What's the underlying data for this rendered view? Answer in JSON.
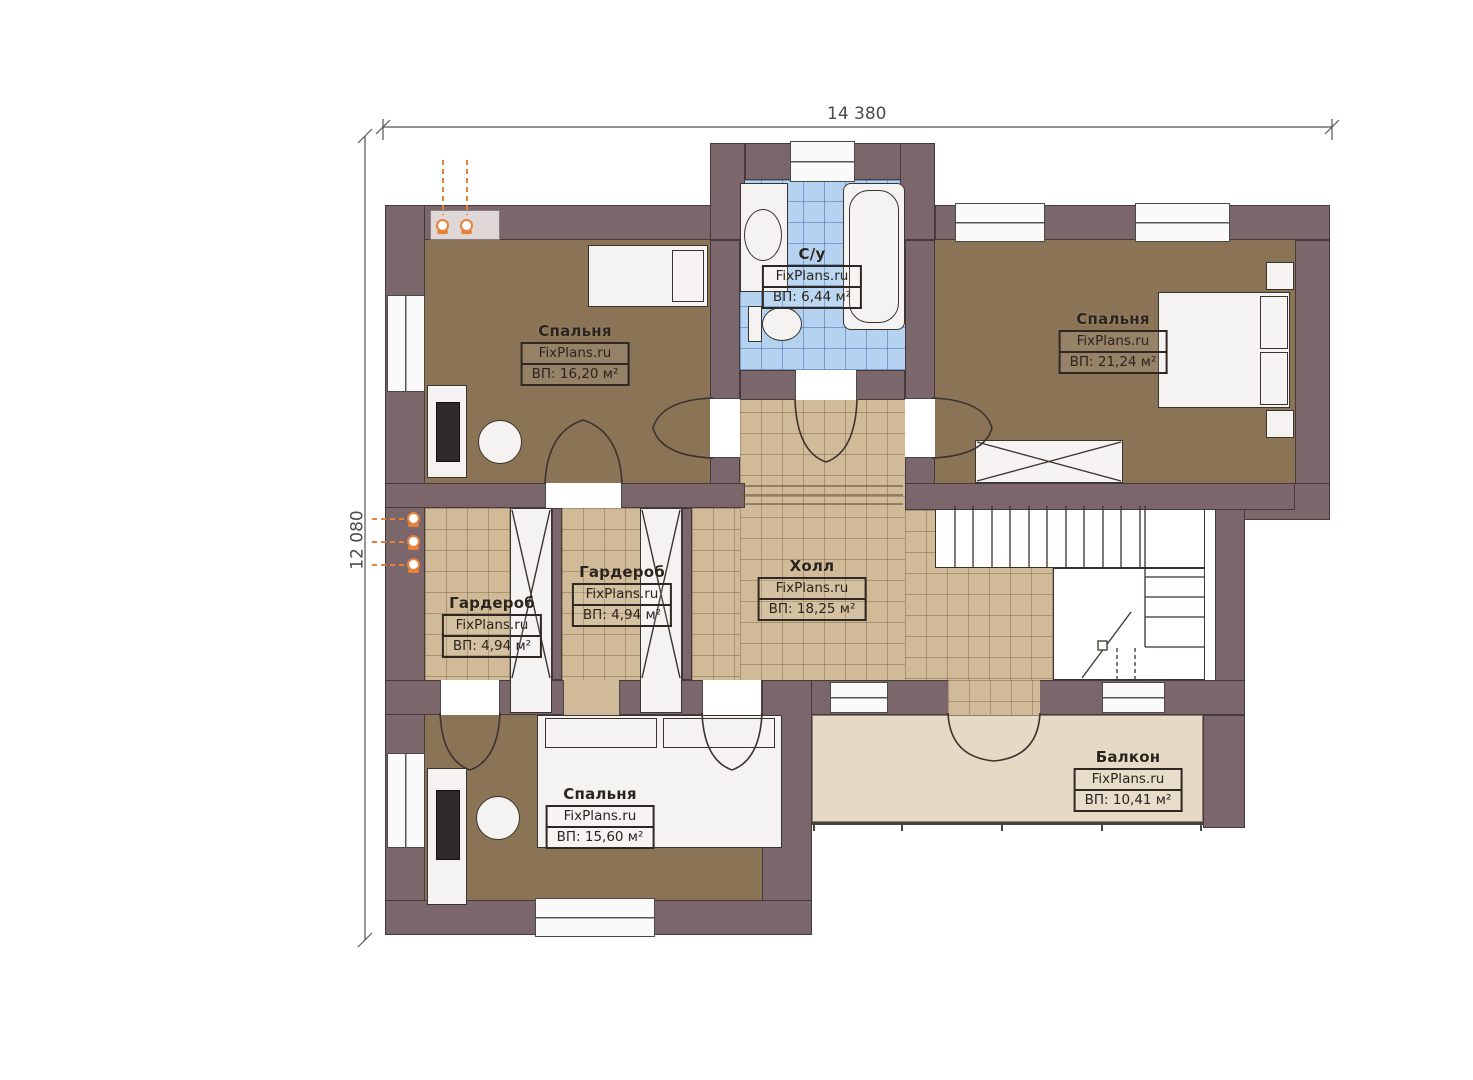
{
  "plan": {
    "title": "floor-plan-second-level",
    "dimensions": {
      "top": "14 380",
      "left": "12 080"
    },
    "rooms": [
      {
        "name": "Спальня",
        "watermark": "FixPlans.ru",
        "area": "ВП: 16,20 м²"
      },
      {
        "name": "С/у",
        "watermark": "FixPlans.ru",
        "area": "ВП: 6,44 м²"
      },
      {
        "name": "Спальня",
        "watermark": "FixPlans.ru",
        "area": "ВП: 21,24 м²"
      },
      {
        "name": "Гардероб",
        "watermark": "FixPlans.ru",
        "area": "ВП: 4,94 м²"
      },
      {
        "name": "Гардероб",
        "watermark": "FixPlans.ru",
        "area": "ВП: 4,94 м²"
      },
      {
        "name": "Холл",
        "watermark": "FixPlans.ru",
        "area": "ВП: 18,25 м²"
      },
      {
        "name": "Спальня",
        "watermark": "FixPlans.ru",
        "area": "ВП: 15,60 м²"
      },
      {
        "name": "Балкон",
        "watermark": "FixPlans.ru",
        "area": "ВП: 10,41 м²"
      }
    ],
    "colors": {
      "wall": "#7b666c",
      "bedroom_floor": "#8b7456",
      "tile_floor": "#d0ba97",
      "bathroom_tile": "#b5d3f0",
      "balcony_floor": "#e6dac5",
      "heating_accent": "#e8813a"
    }
  }
}
